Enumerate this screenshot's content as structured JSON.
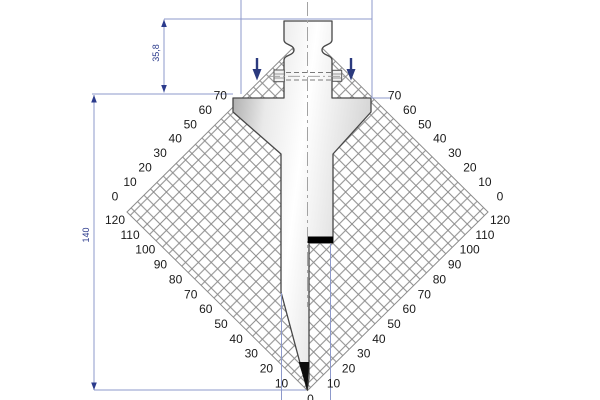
{
  "drawing": {
    "title": "press-brake-punch-technical-drawing",
    "dimensions": {
      "shank_height_label": "35,8",
      "total_height_label": "140"
    },
    "scales": {
      "upper_left": [
        "70",
        "60",
        "50",
        "40",
        "30",
        "20",
        "10",
        "0"
      ],
      "lower_left": [
        "120",
        "110",
        "100",
        "90",
        "80",
        "70",
        "60",
        "50",
        "40",
        "30",
        "20",
        "10"
      ],
      "upper_right": [
        "70",
        "60",
        "50",
        "40",
        "30",
        "20",
        "10",
        "0"
      ],
      "lower_right": [
        "120",
        "110",
        "100",
        "90",
        "80",
        "70",
        "60",
        "50",
        "40",
        "30",
        "20",
        "10"
      ],
      "bottom_vertex_label": "0"
    },
    "colors": {
      "dimension_line": "#8d99cb",
      "dimension_text": "#2b3a8c",
      "press_arrow": "#2b3a7e",
      "hatch_line": "#8c8c8c",
      "scale_text": "#1a1a1a",
      "punch_outline": "#474747",
      "marker_black": "#000000"
    }
  }
}
